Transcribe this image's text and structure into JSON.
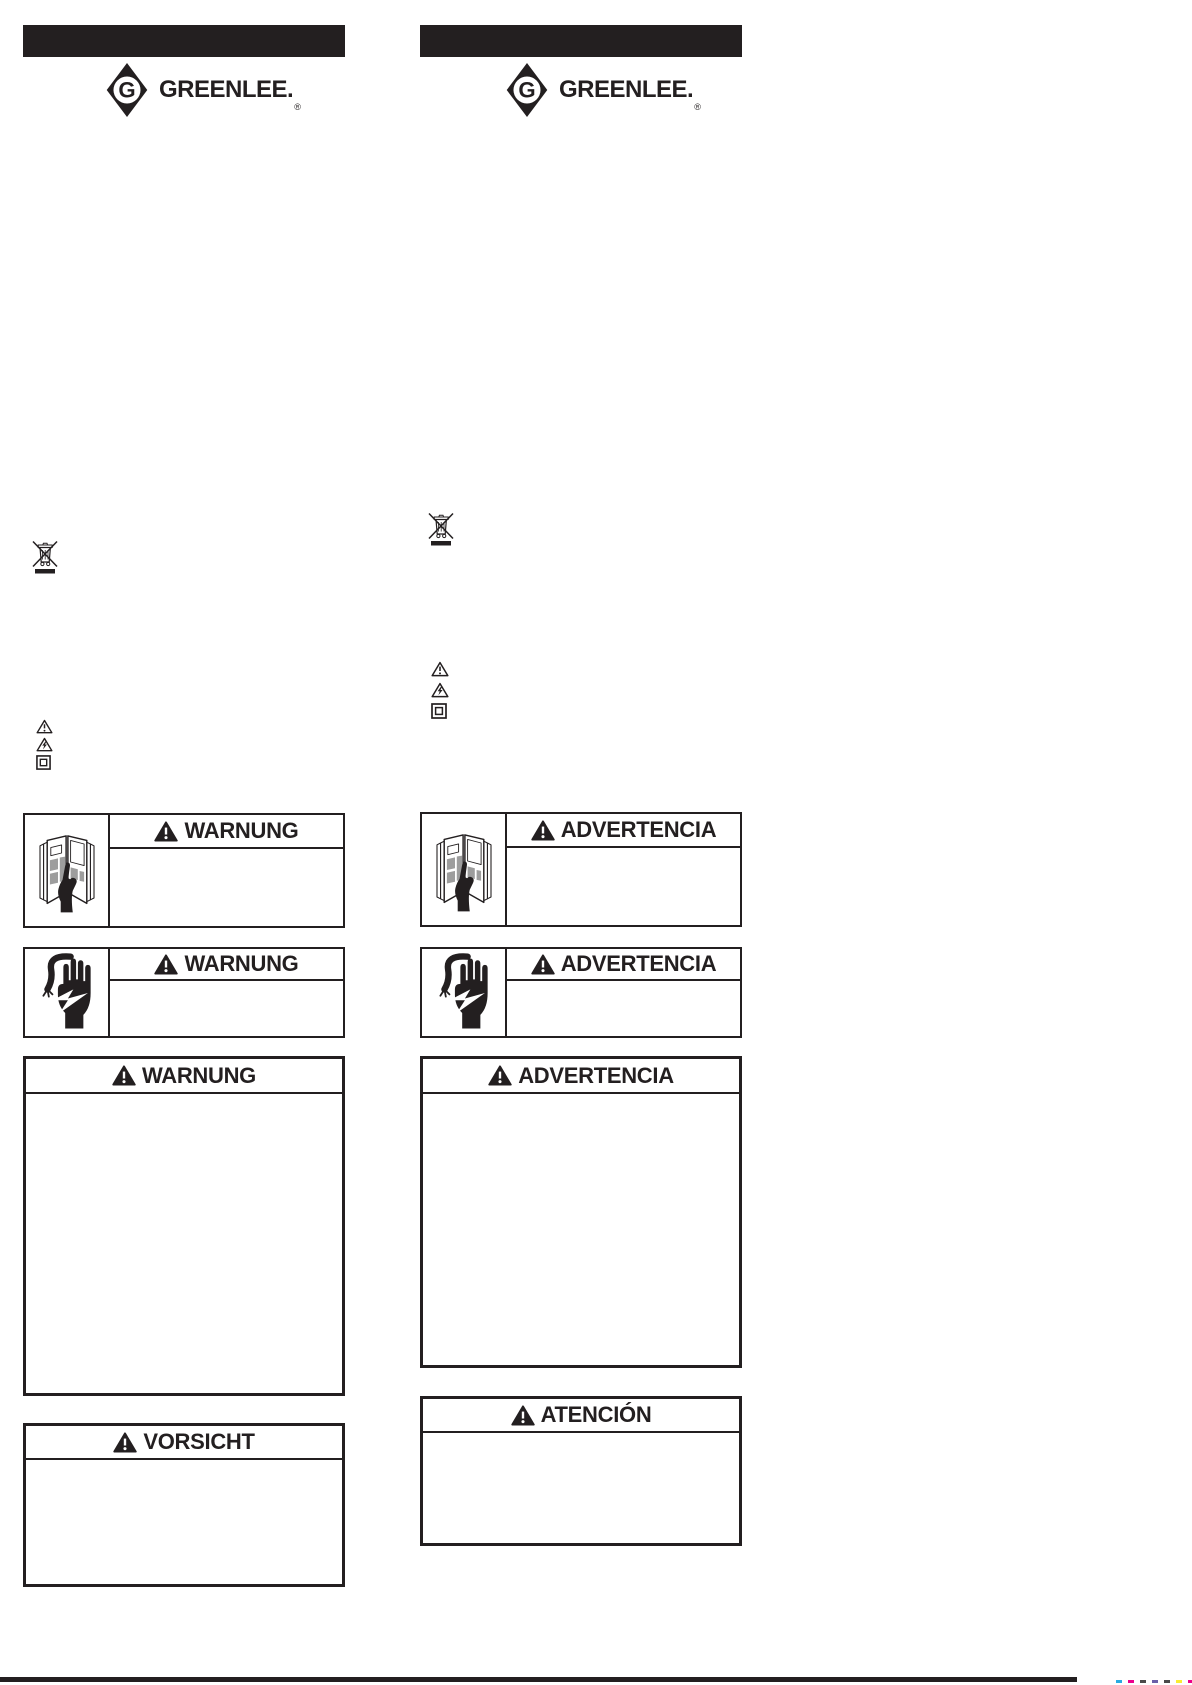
{
  "page": {
    "background": "#ffffff",
    "ink": "#231f20"
  },
  "brand": {
    "name": "GREENLEE.",
    "monogram": "G",
    "registered": "®"
  },
  "icons": {
    "weee": "weee-crossed-out-wheeled-bin-icon",
    "symbols": [
      "alert-triangle-icon",
      "electric-hazard-triangle-icon",
      "double-insulation-square-icon"
    ],
    "manual": "read-operator-manual-icon",
    "shock": "electric-shock-hand-icon",
    "header_triangle": "warning-triangle-icon"
  },
  "german": {
    "warning_box_manual": {
      "title": "WARNUNG"
    },
    "warning_box_shock": {
      "title": "WARNUNG"
    },
    "warning_box_main": {
      "title": "WARNUNG"
    },
    "caution_box": {
      "title": "VORSICHT"
    }
  },
  "spanish": {
    "warning_box_manual": {
      "title": "ADVERTENCIA"
    },
    "warning_box_shock": {
      "title": "ADVERTENCIA"
    },
    "warning_box_main": {
      "title": "ADVERTENCIA"
    },
    "caution_box": {
      "title": "ATENCIÓN"
    }
  },
  "footer": {
    "registration_colors": [
      "#29abe2",
      "#ec008c",
      "#4a4a4a",
      "#6a5fa8",
      "#4a4a4a",
      "#f9ed32",
      "#ec008c",
      "#4a4a4a"
    ]
  }
}
